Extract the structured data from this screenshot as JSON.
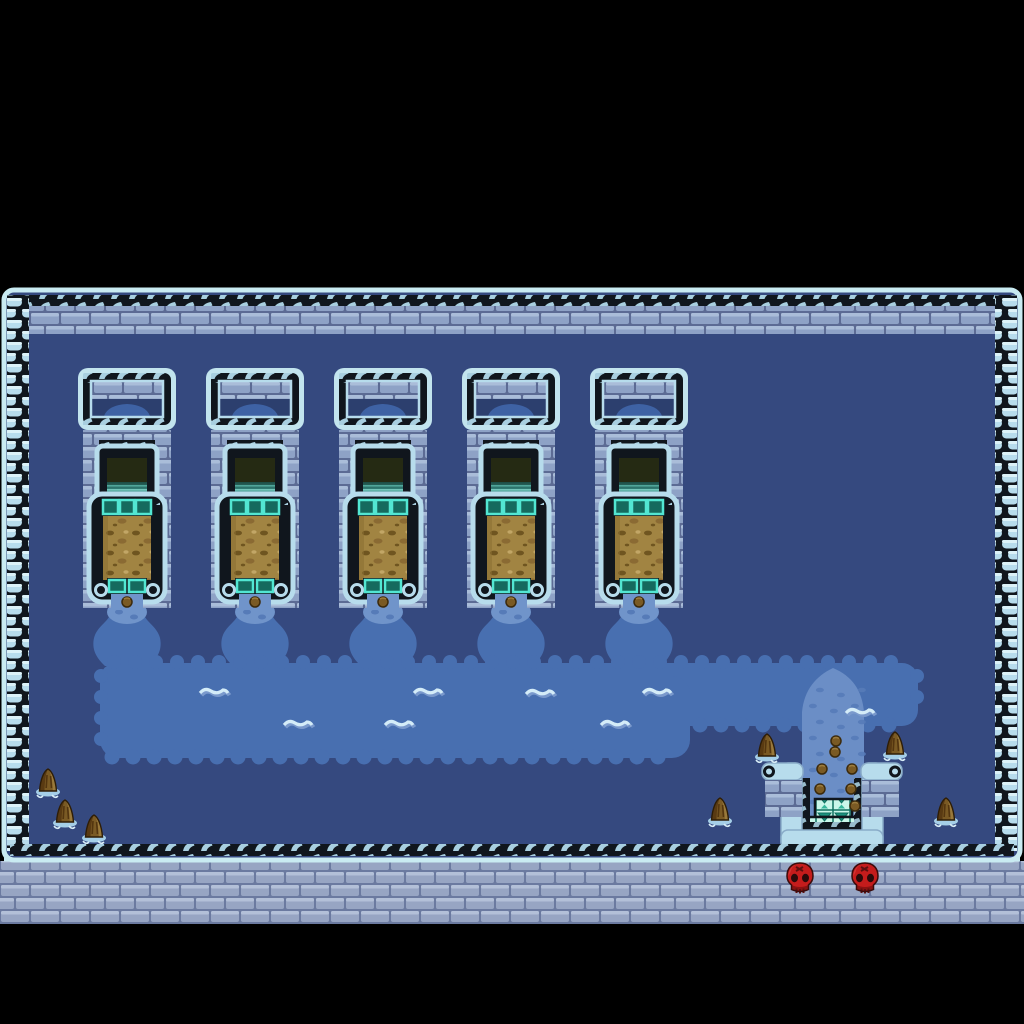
{
  "scene": {
    "name": "water-temple-map",
    "width": 1024,
    "height": 1024,
    "map": {
      "x": 0,
      "y": 288,
      "width": 1024,
      "height": 637
    }
  },
  "palette": {
    "background_black": "#000000",
    "outline_dark": "#10161d",
    "ice_light": "#c9ebf2",
    "ice_mid": "#b7dcec",
    "ice_edge": "#89abc8",
    "hook_light": "#a8cfe0",
    "brick_fill": "#8ea2c6",
    "brick_highlight": "#aabdd9",
    "brick_grout": "#5c6b94",
    "brick_lower_fill": "#97a5c3",
    "brick_lower_grout": "#6b7aa0",
    "floor_navy": "#35497f",
    "recess_navy": "#2c3f6e",
    "pool_blue": "#486fb0",
    "stream_light": "#7094ca",
    "stream_spot": "#567bb8",
    "slide_blue": "#6b8ec6",
    "wave_crest": "#d4ecf8",
    "wave_shadow": "#7a99cc",
    "mound_blue": "#3e62a4",
    "opening_dark": "#252a13",
    "fall_dark": "#1d4a42",
    "fall_mid": "#2f7a72",
    "fall_light": "#8fe0d4",
    "tile_teal_border": "#52e6d2",
    "tile_teal_fill": "#156a5e",
    "grate_mint": "#c9f7ea",
    "grate_teal": "#1c9480",
    "sand_base": "#a18442",
    "sand_dark": "#6f5520",
    "sand_light": "#c2a666",
    "rock_dark": "#53350f",
    "rock_mid": "#7a5a24",
    "rock_light": "#9c7c3e",
    "ripple_blue": "#a5cfe8",
    "skull_red": "#c41c1c",
    "skull_shadow": "#8c1212",
    "pebble_brown": "#7a5a24"
  },
  "structures": {
    "count": 5,
    "unit_width": 98,
    "unit_height": 240,
    "top_y": 368,
    "xs": [
      78,
      206,
      334,
      462,
      590
    ]
  },
  "water": {
    "pool": {
      "left": 100,
      "top": 663,
      "right": 918,
      "bottom_main": 758,
      "bottom_arm": 726,
      "deep_right": 690
    },
    "waves": [
      [
        198,
        684
      ],
      [
        282,
        716
      ],
      [
        383,
        716
      ],
      [
        412,
        684
      ],
      [
        524,
        685
      ],
      [
        599,
        716
      ],
      [
        641,
        684
      ],
      [
        844,
        704
      ]
    ],
    "drain": {
      "slide_left": 802,
      "slide_right": 864,
      "slide_center": 833,
      "wall_top": 763
    }
  },
  "rocks": [
    [
      38,
      768
    ],
    [
      55,
      799
    ],
    [
      84,
      814
    ],
    [
      757,
      733
    ],
    [
      885,
      731
    ],
    [
      710,
      797
    ],
    [
      936,
      797
    ]
  ],
  "skulls": [
    [
      785,
      862
    ],
    [
      850,
      862
    ]
  ],
  "slide_pebbles": [
    [
      836,
      741
    ],
    [
      835,
      752
    ],
    [
      822,
      769
    ],
    [
      852,
      769
    ],
    [
      820,
      789
    ],
    [
      851,
      789
    ],
    [
      855,
      806
    ]
  ]
}
